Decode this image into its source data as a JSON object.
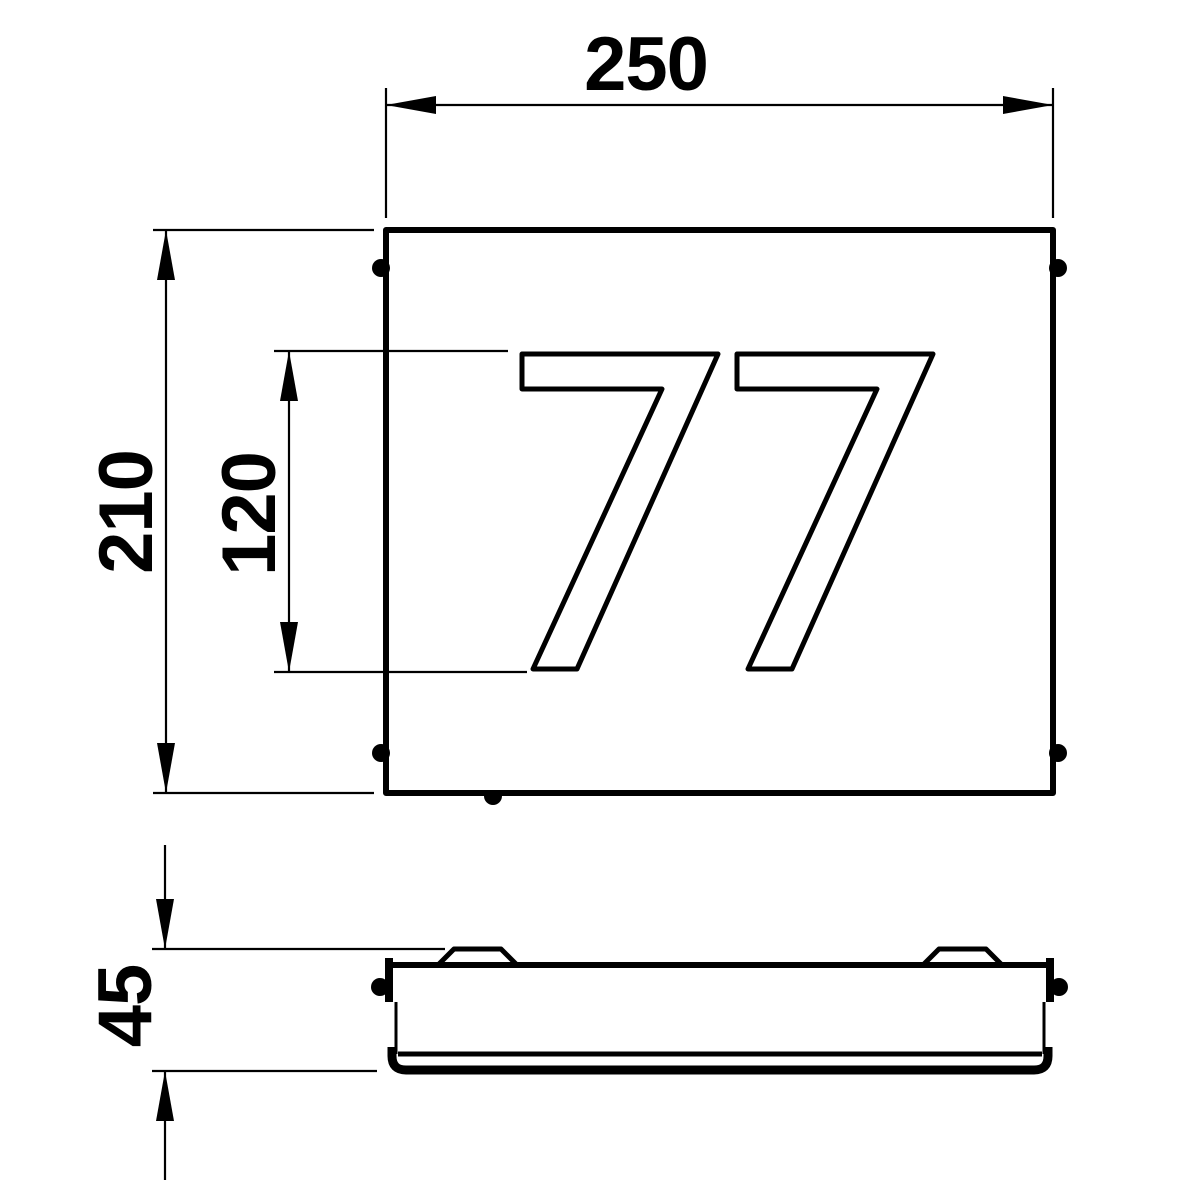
{
  "house_number": "77",
  "dimensions": {
    "width": {
      "label": "250"
    },
    "height": {
      "label": "210"
    },
    "digit_height": {
      "label": "120"
    },
    "depth": {
      "label": "45"
    }
  },
  "colors": {
    "line": "#000000",
    "background": "#ffffff"
  }
}
